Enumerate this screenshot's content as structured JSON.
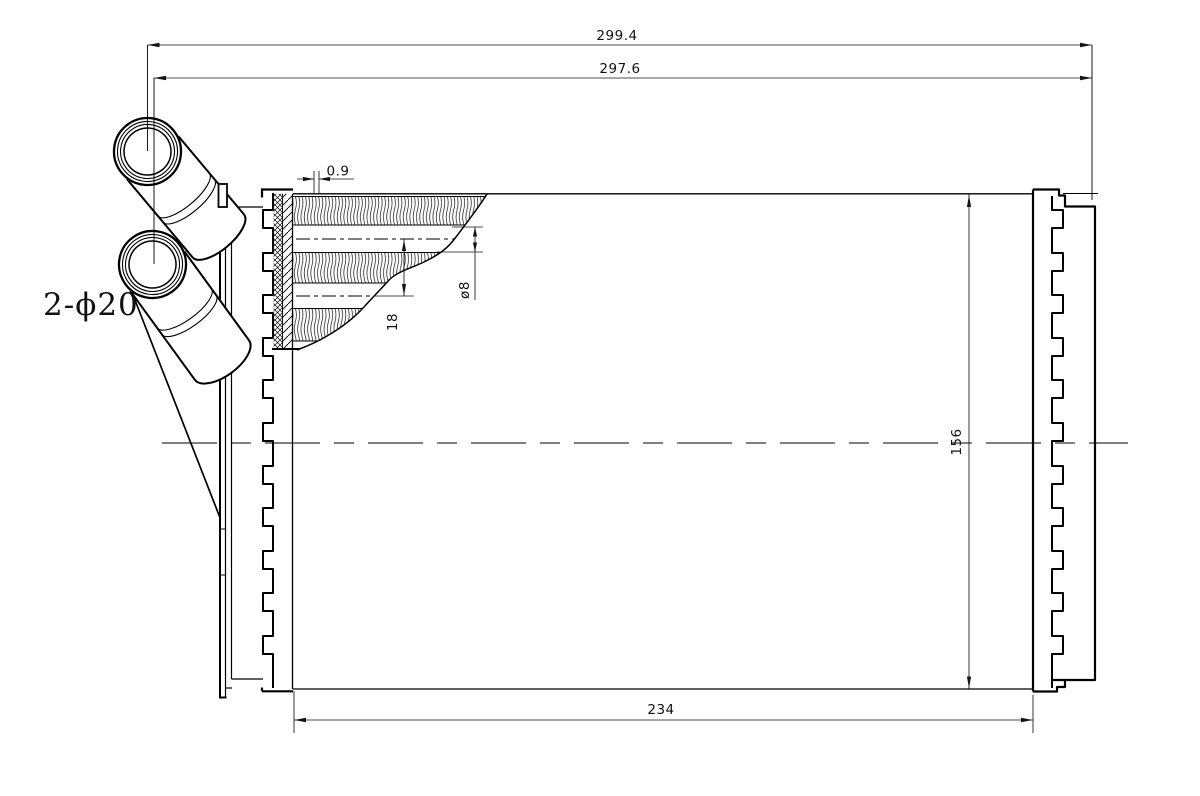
{
  "drawing": {
    "label_pipes": "2-ϕ20",
    "dimensions": {
      "overall_width": "299.4",
      "header_width": "297.6",
      "fin_thickness": "0.9",
      "tube_diameter": "ø8",
      "tube_pitch": "18",
      "core_height": "156",
      "core_width": "234"
    }
  }
}
